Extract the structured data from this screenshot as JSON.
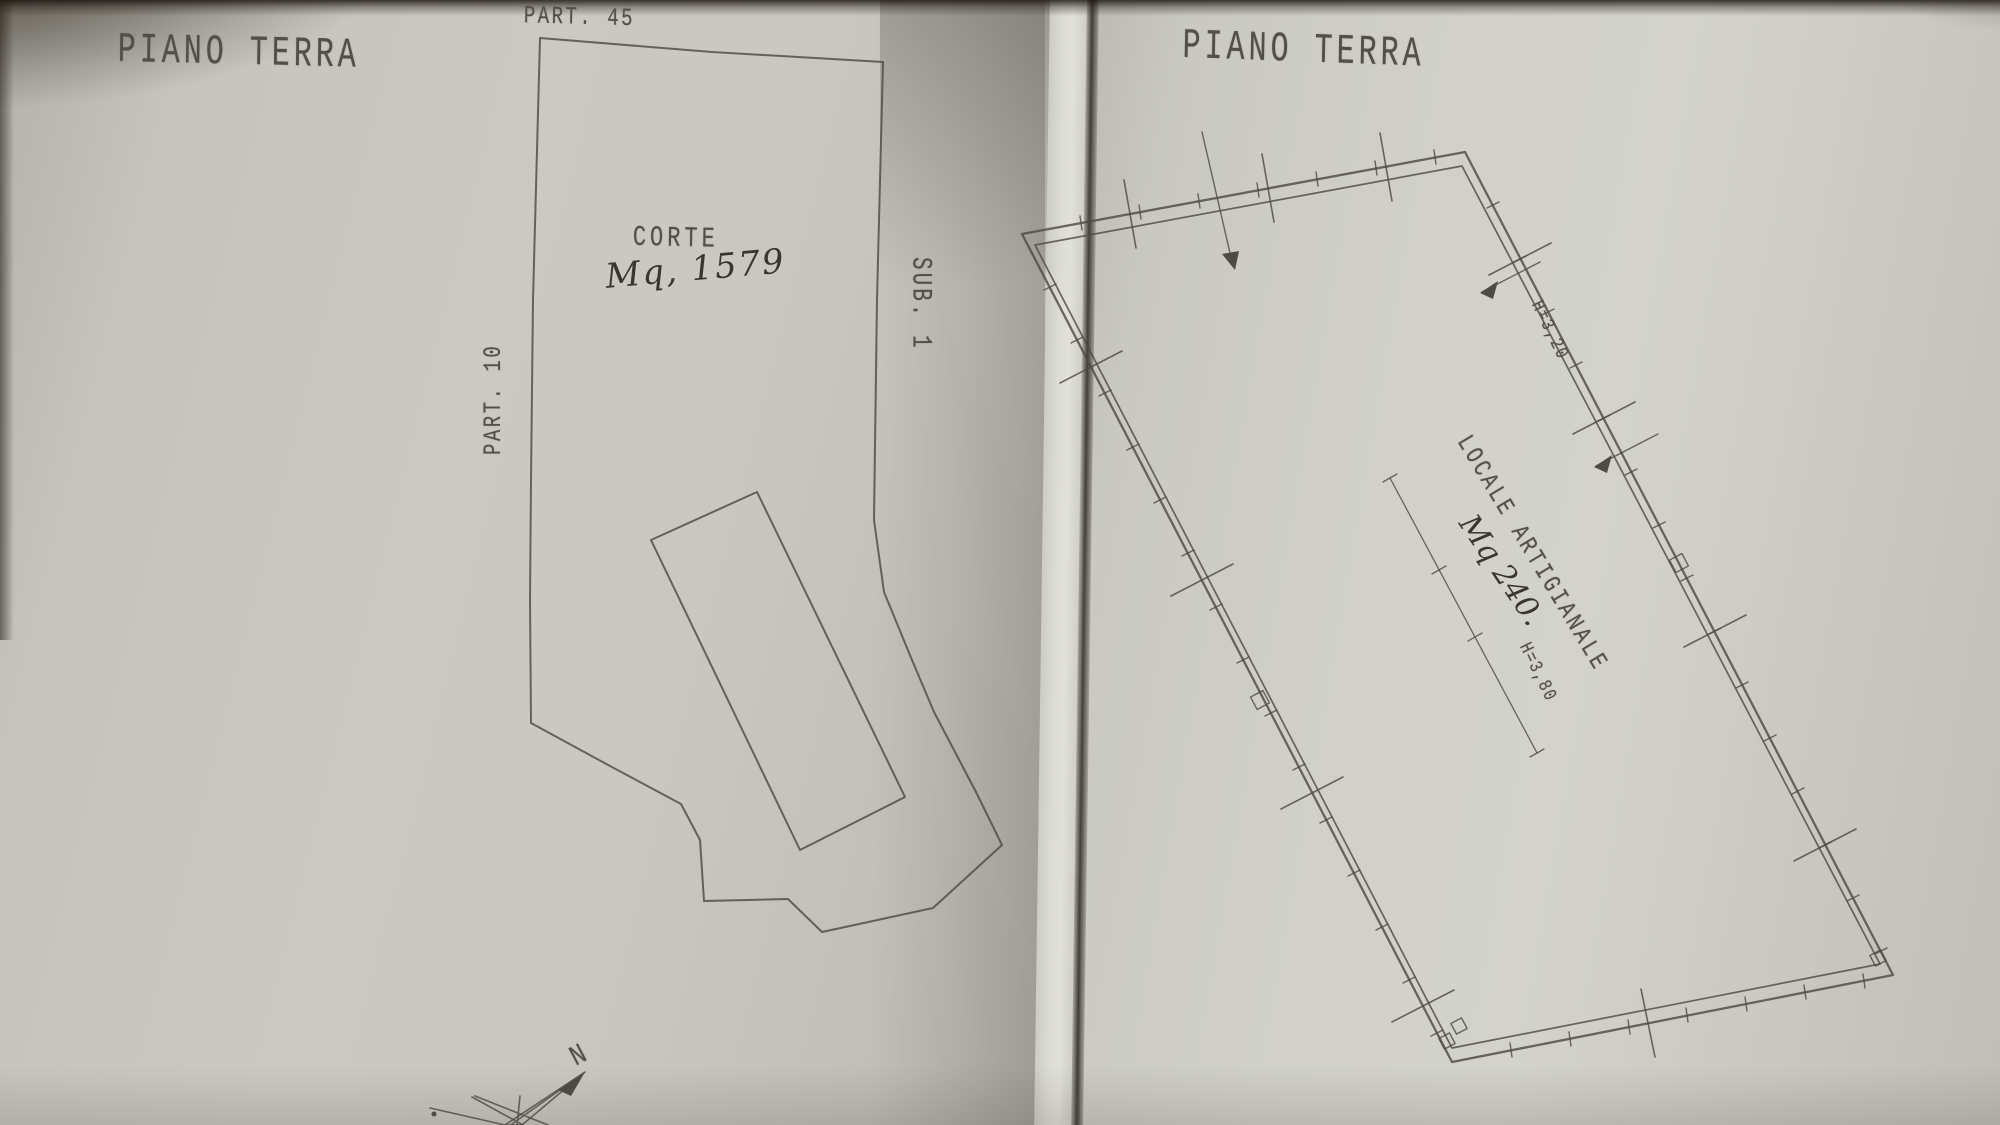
{
  "left_sheet": {
    "title": "PIANO TERRA",
    "labels": {
      "parcel_top": "PART. 45",
      "parcel_left": "PART. 10",
      "sub": "SUB. 1",
      "court": "CORTE",
      "area_handwritten": "Mq, 1579",
      "compass_north": "N"
    }
  },
  "right_sheet": {
    "title": "PIANO TERRA",
    "labels": {
      "room": "LOCALE ARTIGIANALE",
      "area_handwritten": "Mq 240.",
      "height_upper": "H=3,20",
      "height_lower": "H=3,80"
    }
  },
  "colors": {
    "ink": "#4f4a43",
    "paper_left": "#c8c6c0",
    "paper_right": "#cfcec8",
    "seam_shadow": "#46403a"
  }
}
